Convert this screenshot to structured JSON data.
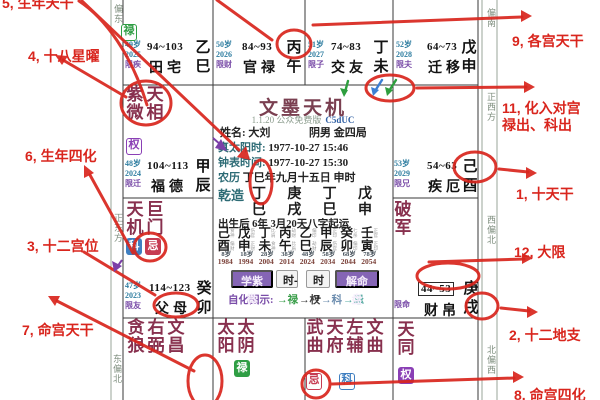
{
  "app": {
    "title": "文墨天机",
    "version": "1.1.20 公众免费版",
    "build_code": "C5dUC",
    "person": {
      "name_line": "姓名: 大刘",
      "gender_bureau": "阴男 金四局",
      "true_solar_label": "真太阳时:",
      "true_solar_value": "1977-10-27  15:46",
      "clock_label": "钟表时间:",
      "clock_value": "1977-10-27  15:30",
      "lunar_label": "农历",
      "lunar_stem": "丁",
      "lunar_rest": "巳年九月十五日 申时",
      "qianzao_label": "乾造",
      "pillar_stems": [
        "丁",
        "庚",
        "丁",
        "戊"
      ],
      "pillar_branches": [
        "巳",
        "戌",
        "巳",
        "申"
      ],
      "luck_start": "出生后 6年 3月20天八字起运"
    },
    "dayun": {
      "stems": [
        "己",
        "戊",
        "丁",
        "丙",
        "乙",
        "甲",
        "癸",
        "壬"
      ],
      "stem_gods": [
        "食神",
        "伤官",
        "比肩",
        "劫财",
        "偏印",
        "正印",
        "七杀",
        "正官"
      ],
      "branches": [
        "酉",
        "申",
        "未",
        "午",
        "巳",
        "辰",
        "卯",
        "寅"
      ],
      "branch_gods": [
        "偏财",
        "正财",
        "食神",
        "比肩",
        "劫财",
        "伤官",
        "偏印",
        "正印"
      ],
      "ages": [
        "8岁",
        "18岁",
        "28岁",
        "38岁",
        "48岁",
        "58岁",
        "68岁",
        "78岁"
      ],
      "years": [
        "1984",
        "1994",
        "2004",
        "2014",
        "2024",
        "2034",
        "2044",
        "2054"
      ]
    },
    "buttons": [
      "学紫微",
      "时-",
      "时+",
      "解命盘"
    ],
    "legend": {
      "label": "自化图示:",
      "items": [
        {
          "t": "→禄",
          "c": "lu"
        },
        {
          "t": "→权",
          "c": "quan2"
        },
        {
          "t": "→科",
          "c": "ke2"
        },
        {
          "t": "→忌",
          "c": "ji2"
        }
      ]
    }
  },
  "palaces": {
    "si": {
      "age": "49岁",
      "year": "2025",
      "flow": "限疾",
      "range": "94~103",
      "name": "田宅",
      "stem": "乙",
      "branch": "巳"
    },
    "wu": {
      "age": "50岁",
      "year": "2026",
      "flow": "限财",
      "range": "84~93",
      "name": "官禄",
      "stem": "丙",
      "branch": "午"
    },
    "wei": {
      "age": "51岁",
      "year": "2027",
      "flow": "限子",
      "range": "74~83",
      "name": "交友",
      "stem": "丁",
      "branch": "未"
    },
    "shen": {
      "age": "52岁",
      "year": "2028",
      "flow": "限夫",
      "range": "64~73",
      "name": "迁移",
      "stem": "戊",
      "branch": "申"
    },
    "chen": {
      "age": "48岁",
      "year": "2024",
      "flow": "限迁",
      "range": "104~113",
      "name": "福德",
      "stem": "甲",
      "branch": "辰",
      "stars": [
        "紫微",
        "天相"
      ]
    },
    "you": {
      "age": "53岁",
      "year": "2029",
      "flow": "限兄",
      "range": "54~63",
      "name": "疾厄",
      "stem": "己",
      "branch": "酉"
    },
    "mao": {
      "age": "47岁",
      "year": "2023",
      "flow": "限友",
      "range": "114~123",
      "name": "父母",
      "stem": "癸",
      "branch": "卯",
      "stars": [
        "天机",
        "巨门"
      ]
    },
    "xu": {
      "flow": "限命",
      "range": "44~53",
      "name": "财帛",
      "stem": "庚",
      "branch": "戌",
      "stars": [
        "破军"
      ]
    },
    "yin": {
      "stars": [
        "贪狼",
        "右弼",
        "文昌"
      ]
    },
    "chou": {
      "stars": [
        "太阳",
        "太阴"
      ]
    },
    "zi": {
      "stars": [
        "武曲",
        "天府",
        "左辅",
        "文曲"
      ]
    },
    "hai": {
      "stars": [
        "天同"
      ]
    }
  },
  "badges": {
    "si_lu": "禄",
    "chen_quan": "权",
    "mao_ke": "科",
    "mao_ji": "忌",
    "chou_lu": "禄",
    "zi_ji": "忌",
    "zi_ke": "科",
    "hai_quan": "权"
  },
  "compass": {
    "left_top": "偏东",
    "left_mid": "正东方",
    "left_bottom": "东偏北",
    "right_top": "偏南",
    "right_upper": "正西方",
    "right_lower": "西偏北",
    "right_bottom": "北偏西"
  },
  "annotations": {
    "a1": "1, 十天干",
    "a2": "2, 十二地支",
    "a3": "3, 十二宫位",
    "a4": "4, 十八星曜",
    "a5": "5, 生年天干",
    "a6": "6, 生年四化",
    "a7": "7, 命宫天干",
    "a8": "8, 命宫四化",
    "a9": "9, 各宫天干",
    "a11_line1": "11, 化入对宫",
    "a11_line2": "禄出、科出",
    "a12": "12, 大限"
  },
  "colors": {
    "annotation_red": "#d9251d",
    "star_maroon": "#88304e",
    "lu_green": "#2f9e44",
    "quan_purple": "#8a3fb5",
    "ke_blue": "#3f7fc1",
    "ji_red": "#c63b52",
    "button_purple": "#8565b5"
  }
}
